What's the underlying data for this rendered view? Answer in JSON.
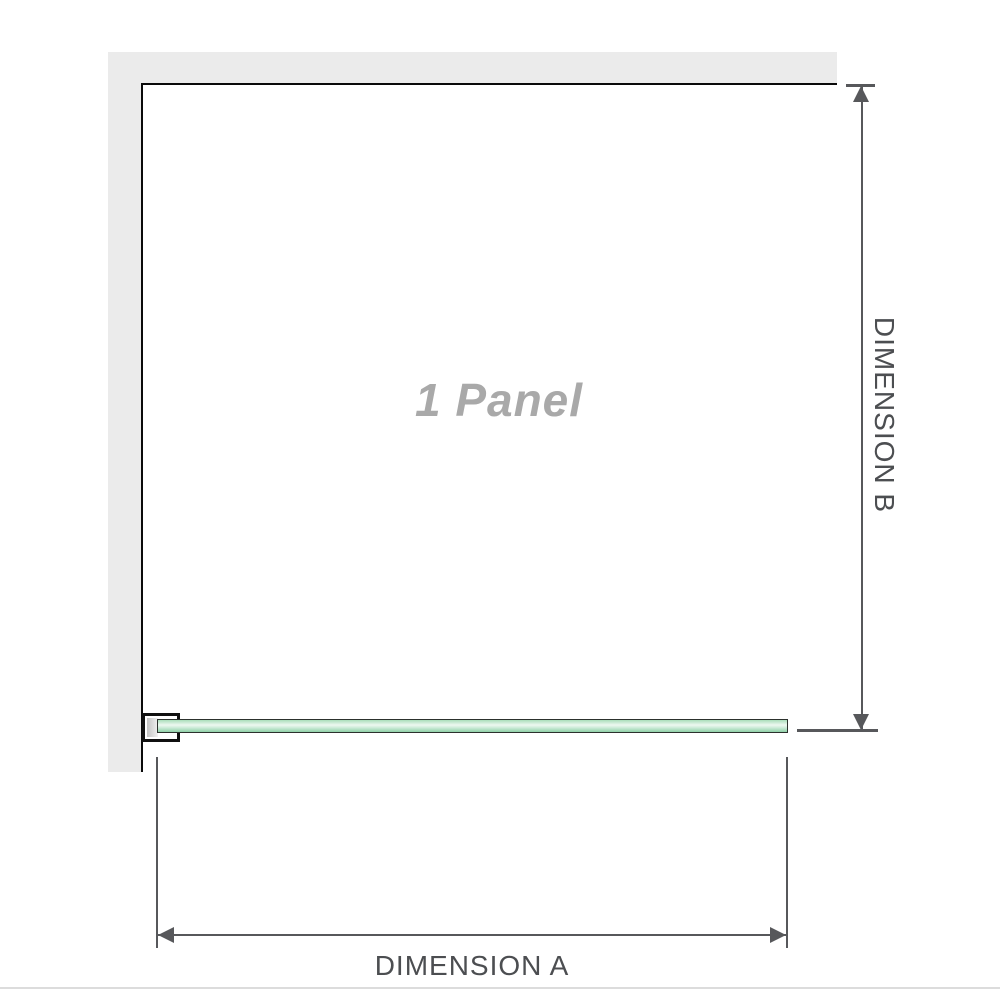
{
  "diagram": {
    "panel_label": "1 Panel",
    "dimension_a_label": "DIMENSION A",
    "dimension_b_label": "DIMENSION B"
  },
  "colors": {
    "wall": "#ebebeb",
    "outline": "#0a0a0a",
    "dimension": "#57585b",
    "label_text": "#4c4e51",
    "panel_label": "#a9a9a9",
    "bracket_border": "#101010",
    "pad_dark": "#c3c3c3",
    "pad_light": "#f1f1f1",
    "glass_border": "#2c312d",
    "glass_g1": "#a9ddba",
    "glass_g2": "#eef8f1",
    "glass_g3": "#cdebd8",
    "glass_g4": "#8fd0a7",
    "divider": "#dcdcdc"
  }
}
